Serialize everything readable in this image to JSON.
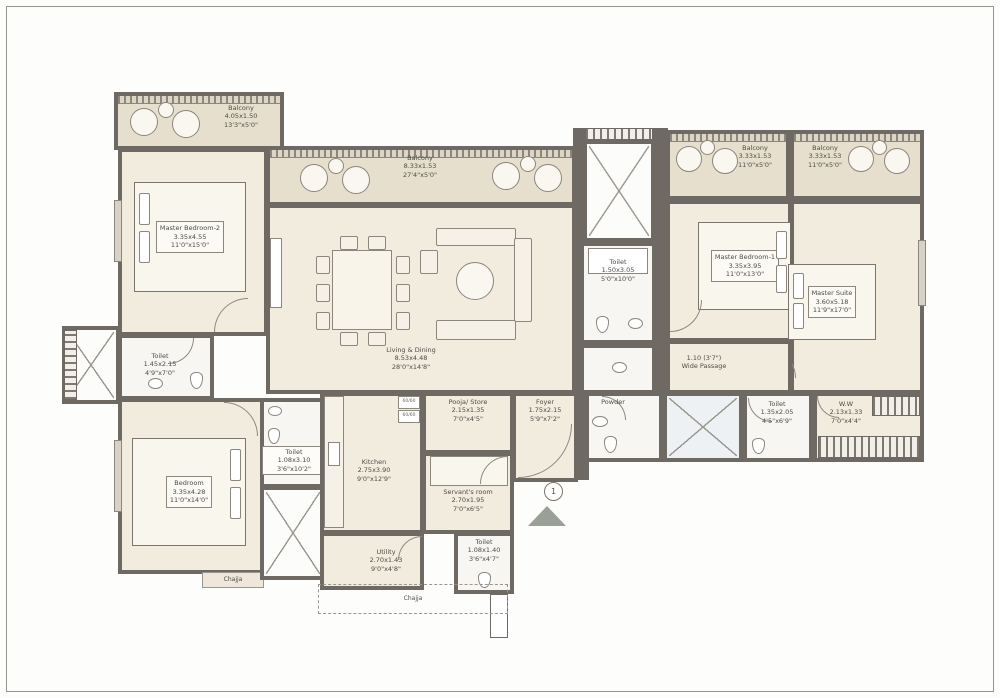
{
  "plan": {
    "title": "Apartment Floor Plan",
    "entry_marker": "1",
    "kitchen_hob": "60/60",
    "rooms": {
      "balcony_tl": {
        "name": "Balcony",
        "m": "4.05x1.50",
        "ft": "13'3\"x5'0\""
      },
      "balcony_mid": {
        "name": "Balcony",
        "m": "8.33x1.53",
        "ft": "27'4\"x5'0\""
      },
      "balcony_r1": {
        "name": "Balcony",
        "m": "3.33x1.53",
        "ft": "11'0\"x5'0\""
      },
      "balcony_r2": {
        "name": "Balcony",
        "m": "3.33x1.53",
        "ft": "11'0\"x5'0\""
      },
      "master_bedroom_2": {
        "name": "Master Bedroom-2",
        "m": "3.35x4.55",
        "ft": "11'0\"x15'0\""
      },
      "toilet_left": {
        "name": "Toilet",
        "m": "1.45x2.15",
        "ft": "4'9\"x7'0\""
      },
      "bedroom": {
        "name": "Bedroom",
        "m": "3.35x4.28",
        "ft": "11'0\"x14'0\""
      },
      "toilet_bedroom": {
        "name": "Toilet",
        "m": "1.08x3.10",
        "ft": "3'6\"x10'2\""
      },
      "living_dining": {
        "name": "Living & Dining",
        "m": "8.53x4.48",
        "ft": "28'0\"x14'8\""
      },
      "kitchen": {
        "name": "Kitchen",
        "m": "2.75x3.90",
        "ft": "9'0\"x12'9\""
      },
      "utility": {
        "name": "Utility",
        "m": "2.70x1.43",
        "ft": "9'0\"x4'8\""
      },
      "pooja_store": {
        "name": "Pooja/ Store",
        "m": "2.15x1.35",
        "ft": "7'0\"x4'5\""
      },
      "servants_room": {
        "name": "Servant's room",
        "m": "2.70x1.95",
        "ft": "7'0\"x6'5\""
      },
      "toilet_servant": {
        "name": "Toilet",
        "m": "1.08x1.40",
        "ft": "3'6\"x4'7\""
      },
      "foyer": {
        "name": "Foyer",
        "m": "1.75x2.15",
        "ft": "5'9\"x7'2\""
      },
      "toilet_center": {
        "name": "Toilet",
        "m": "1.50x3.05",
        "ft": "5'0\"x10'0\""
      },
      "master_bedroom_1": {
        "name": "Master Bedroom-1",
        "m": "3.35x3.95",
        "ft": "11'0\"x13'0\""
      },
      "master_suite": {
        "name": "Master Suite",
        "m": "3.60x5.18",
        "ft": "11'9\"x17'0\""
      },
      "wide_passage": {
        "name": "Wide Passage",
        "m": "1.10 (3'7\")",
        "ft": ""
      },
      "powder": {
        "name": "Powder",
        "m": "",
        "ft": ""
      },
      "toilet_right": {
        "name": "Toilet",
        "m": "1.35x2.05",
        "ft": "4'5\"x6'9\""
      },
      "ww": {
        "name": "W.W",
        "m": "2.13x1.33",
        "ft": "7'0\"x4'4\""
      },
      "chajja_left": {
        "name": "Chajja",
        "m": "",
        "ft": ""
      },
      "chajja_mid": {
        "name": "Chajja",
        "m": "",
        "ft": ""
      }
    }
  }
}
